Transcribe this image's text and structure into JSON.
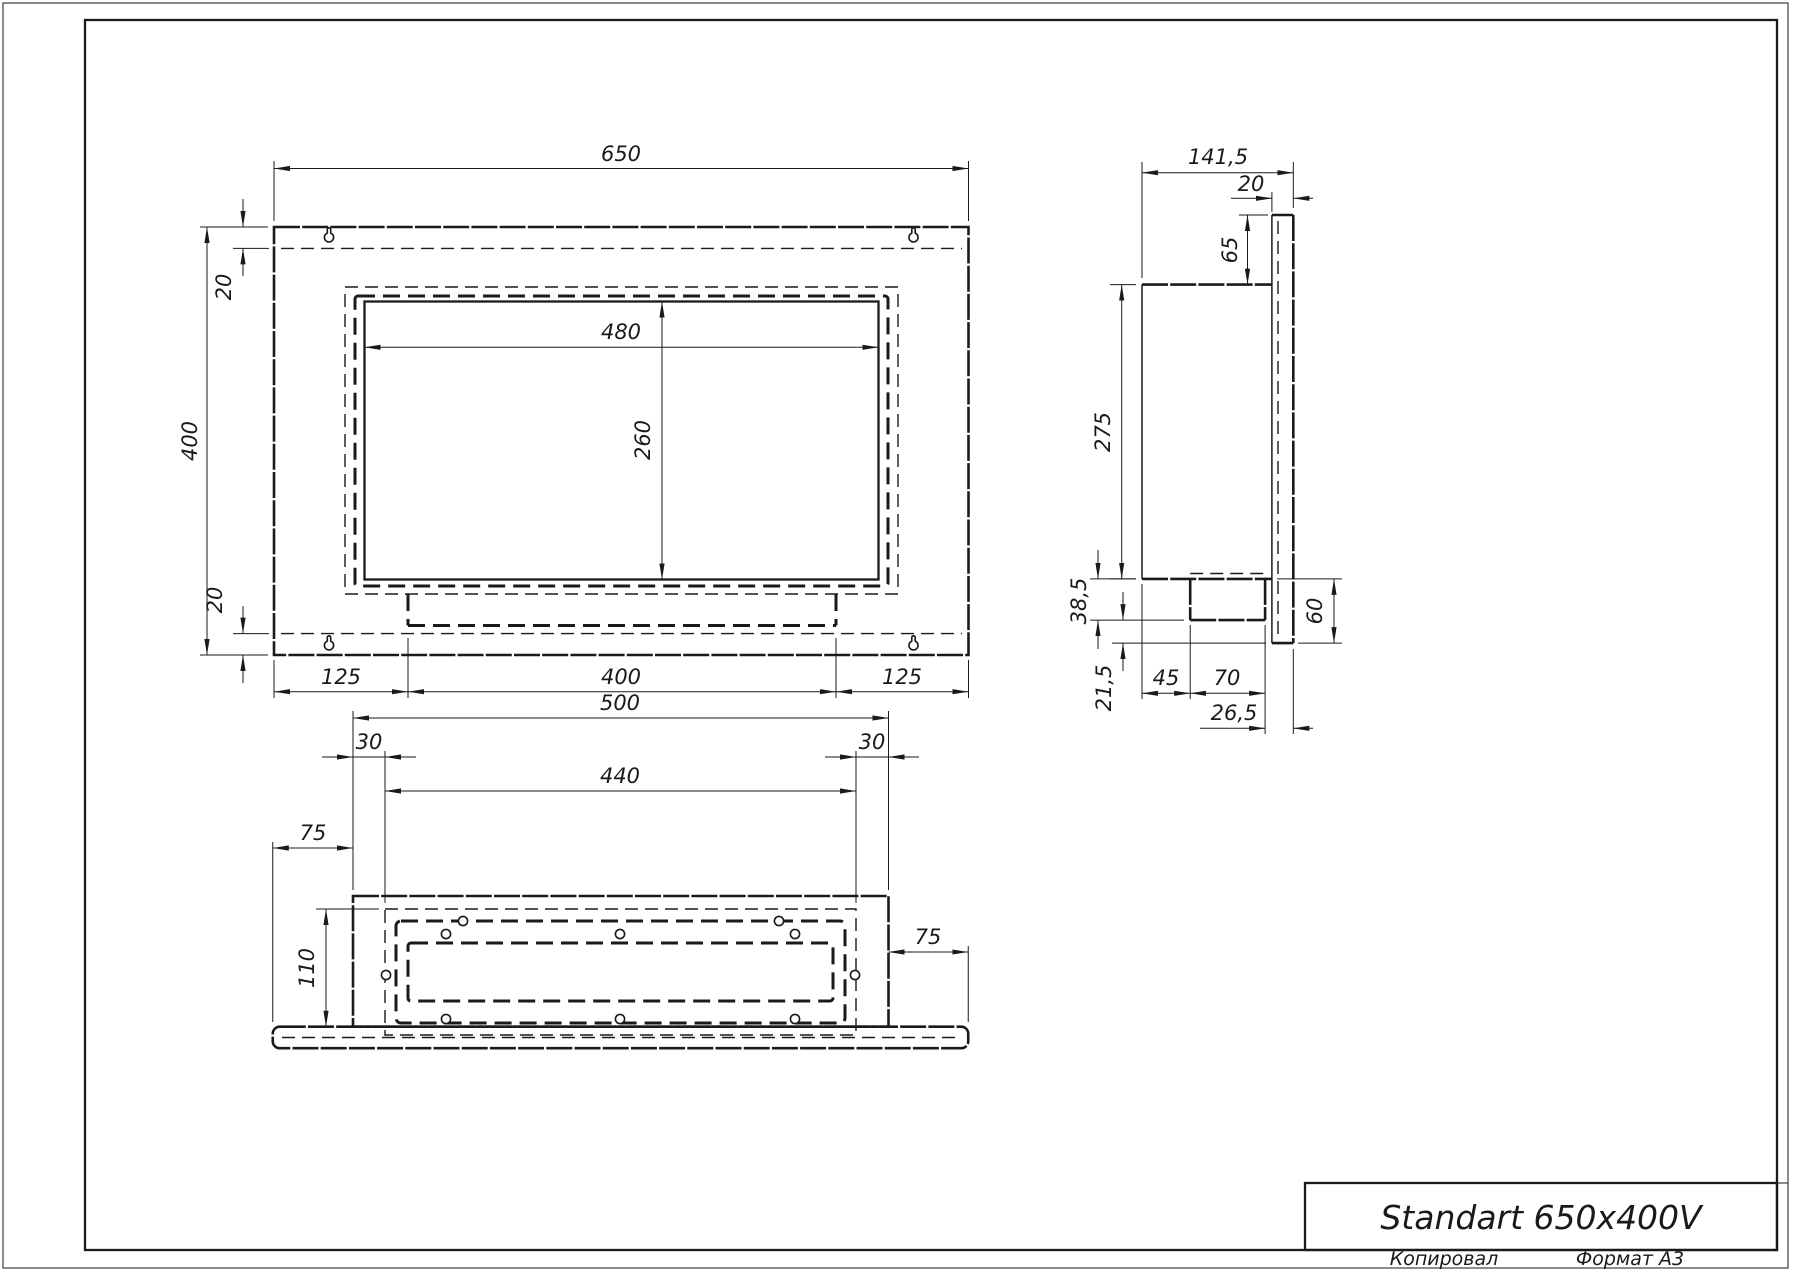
{
  "title_block": {
    "name": "Standart 650x400V",
    "copied_label": "Копировал",
    "format_label": "Формат A3"
  },
  "views": {
    "front": {
      "width": "650",
      "height": "400",
      "top_inset": "20",
      "bottom_inset": "20",
      "opening_width": "480",
      "opening_height": "260",
      "bottom_left": "125",
      "bottom_center": "400",
      "bottom_right": "125"
    },
    "side": {
      "depth": "141,5",
      "frame_depth": "20",
      "frame_top": "65",
      "height": "275",
      "drop_upper": "38,5",
      "drop_lower": "21,5",
      "drop_total": "60",
      "back_gap": "45",
      "tray_depth": "70",
      "front_gap": "26,5"
    },
    "bottom": {
      "width": "500",
      "side_left": "30",
      "inner_width": "440",
      "side_right": "30",
      "overhang_left": "75",
      "overhang_right": "75",
      "inner_depth": "110"
    }
  },
  "colors": {
    "line": "#1a1a1a",
    "background": "#ffffff"
  }
}
